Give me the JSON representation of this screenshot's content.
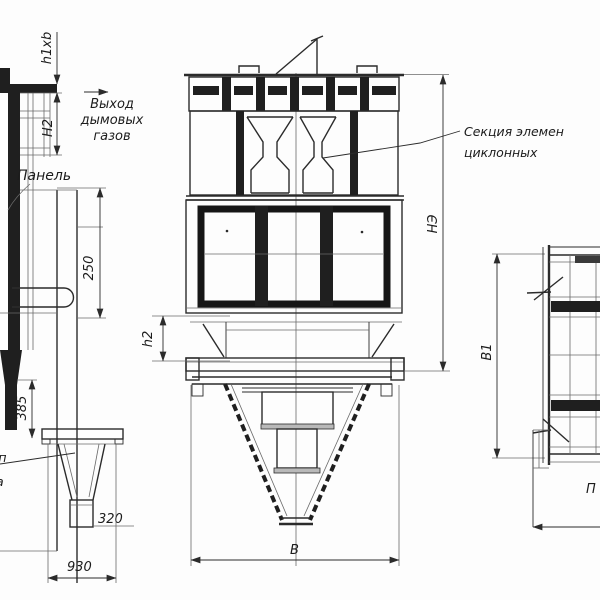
{
  "title": "cyclone-dust-collector-three-view-drawing",
  "labels": {
    "panel": "Панель",
    "gas_exit_line1": "Выход",
    "gas_exit_line2": "дымовых",
    "gas_exit_line3": "газов",
    "section_line1": "Секция элемен",
    "section_line2": "циклонных",
    "partial_left_line1": "уп",
    "partial_left_line2": "а",
    "partial_bottom_right": "П"
  },
  "dimensions": {
    "h1xb": "h1xb",
    "h2_upper": "H2",
    "d250": "250",
    "d385": "385",
    "d320": "320",
    "d930": "930",
    "b_width": "В",
    "h2_lower": "h2",
    "ne_height": "НЭ",
    "b1_width": "В1"
  },
  "colors": {
    "line": "#2b2b2b",
    "thin": "#6a6a6a",
    "background": "#fdfdfd"
  }
}
